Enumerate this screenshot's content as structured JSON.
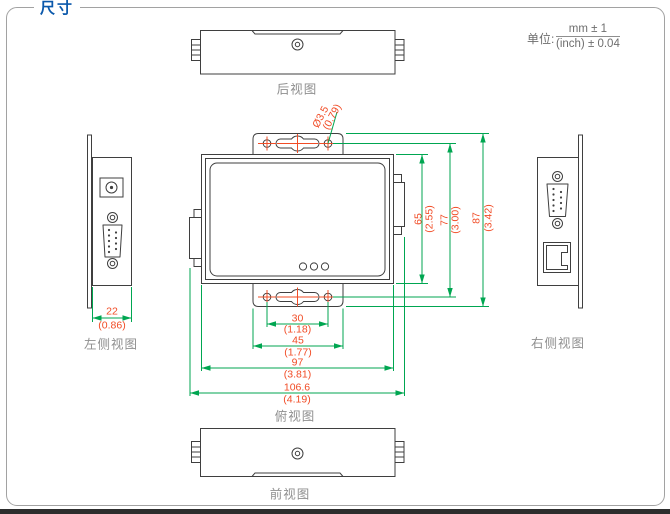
{
  "header": {
    "title": "尺寸",
    "unit_label": "单位:",
    "unit_mm": "mm ± 1",
    "unit_inch": "(inch) ± 0.04"
  },
  "views": {
    "rear": {
      "label": "后视图"
    },
    "top": {
      "label": "俯视图"
    },
    "front": {
      "label": "前视图"
    },
    "left_side": {
      "label": "左侧视图"
    },
    "right_side": {
      "label": "右侧视图"
    }
  },
  "dimensions": {
    "mount_hole_dia": {
      "mm": "Ø3.5",
      "inch": "(0.79)"
    },
    "body_height": {
      "mm": "65",
      "inch": "(2.55)"
    },
    "hole_pitch_vertical": {
      "mm": "77",
      "inch": "(3.00)"
    },
    "overall_height": {
      "mm": "87",
      "inch": "(3.42)"
    },
    "hole_pitch_horizontal": {
      "mm": "30",
      "inch": "(1.18)"
    },
    "bracket_width": {
      "mm": "45",
      "inch": "(1.77)"
    },
    "body_width": {
      "mm": "97",
      "inch": "(3.81)"
    },
    "overall_width": {
      "mm": "106.6",
      "inch": "(4.19)"
    },
    "depth": {
      "mm": "22",
      "inch": "(0.86)"
    }
  },
  "colors": {
    "accent_blue": "#0a58ab",
    "dimension_line_green": "#00a651",
    "dimension_text_red": "#f14c26",
    "outline_gray": "#3f3f3f",
    "label_gray": "#8f8f8f"
  }
}
